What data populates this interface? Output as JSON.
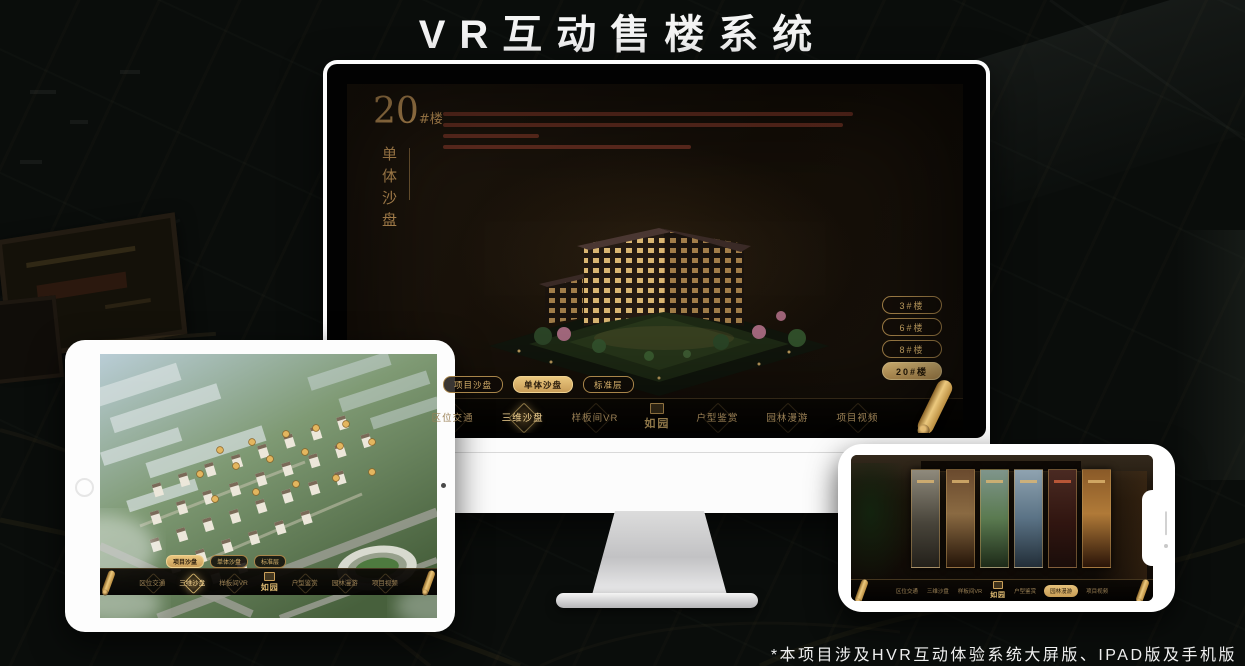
{
  "page": {
    "title": "VR互动售楼系统",
    "footnote": "*本项目涉及HVR互动体验系统大屏版、IPAD版及手机版"
  },
  "colors": {
    "gold": "#c99a5b",
    "gold_bright": "#e3bb72",
    "active_text_dark": "#241807",
    "screen_bg": "#17110a"
  },
  "app": {
    "logo": "如园",
    "nav_items": [
      {
        "label": "区位交通"
      },
      {
        "label": "三维沙盘"
      },
      {
        "label": "样板间VR"
      },
      {
        "label": "户型鉴赏"
      },
      {
        "label": "园林漫游"
      },
      {
        "label": "项目视频"
      }
    ],
    "view_pills": [
      {
        "label": "项目沙盘"
      },
      {
        "label": "单体沙盘"
      },
      {
        "label": "标准层"
      }
    ]
  },
  "monitor_screen": {
    "section_number": "20",
    "section_suffix": "#楼",
    "section_subtitle": "单体沙盘",
    "floor_buttons": [
      {
        "label": "3#楼"
      },
      {
        "label": "6#楼"
      },
      {
        "label": "8#楼"
      },
      {
        "label": "20#楼"
      }
    ],
    "active_floor": "20#楼",
    "active_pill": "单体沙盘",
    "active_nav": "三维沙盘"
  },
  "ipad_screen": {
    "active_pill": "项目沙盘",
    "active_nav": "三维沙盘"
  },
  "phone_screen": {
    "active_nav": "园林漫游"
  }
}
